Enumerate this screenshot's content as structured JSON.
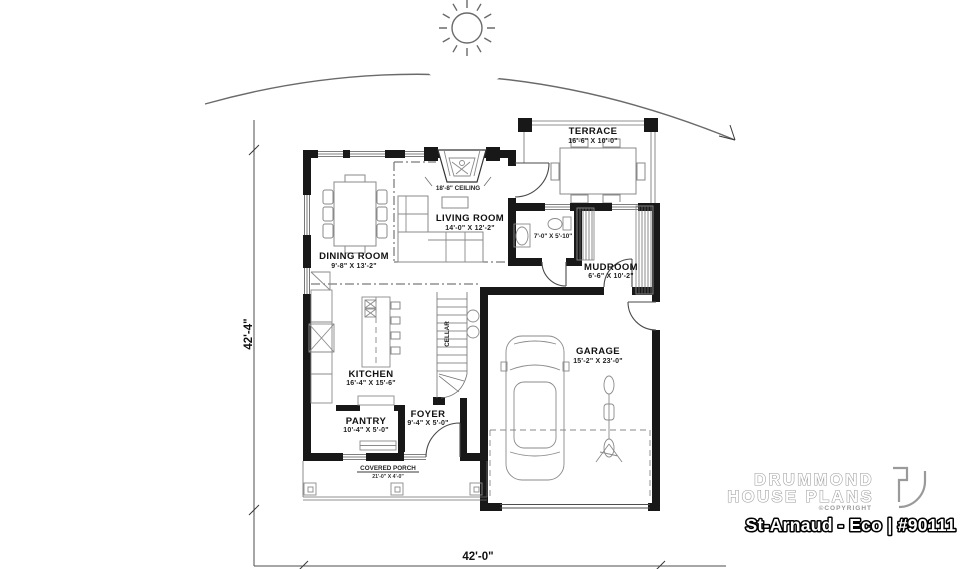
{
  "plan": {
    "footer_title": "St-Arnaud - Eco | #90111",
    "brand": {
      "line1": "DRUMMOND",
      "line2": "HOUSE PLANS",
      "copyright": "©COPYRIGHT"
    },
    "overall": {
      "depth": "42'-4\"",
      "width": "42'-0\""
    },
    "rooms": {
      "terrace": {
        "name": "TERRACE",
        "size": "16'-6\" X 10'-0\""
      },
      "living": {
        "name": "LIVING ROOM",
        "size": "14'-0\" X 12'-2\""
      },
      "dining": {
        "name": "DINING ROOM",
        "size": "9'-8\" X 13'-2\""
      },
      "kitchen": {
        "name": "KITCHEN",
        "size": "16'-4\" X 15'-6\""
      },
      "pantry": {
        "name": "PANTRY",
        "size": "10'-4\" X 5'-0\""
      },
      "foyer": {
        "name": "FOYER",
        "size": "9'-4\" X 5'-0\""
      },
      "mudroom": {
        "name": "MUDROOM",
        "size": "6'-6\" X 10'-2\""
      },
      "garage": {
        "name": "GARAGE",
        "size": "15'-2\" X 23'-0\""
      },
      "porch": {
        "name": "COVERED PORCH",
        "size": "21'-0\" X 4'-0\""
      },
      "bath": {
        "size": "7'-0\" X 5'-10\""
      },
      "cellar": {
        "name": "CELLAR"
      }
    },
    "notes": {
      "ceiling": "18'-8\" CEILING"
    },
    "colors": {
      "wall": "#181818",
      "plan_line": "#4d4d4d",
      "furniture_line": "#8a8a8a",
      "brand_gray": "#9a9a9a",
      "title_fill": "#ffffff",
      "title_outline": "#000000",
      "background": "#ffffff"
    }
  }
}
